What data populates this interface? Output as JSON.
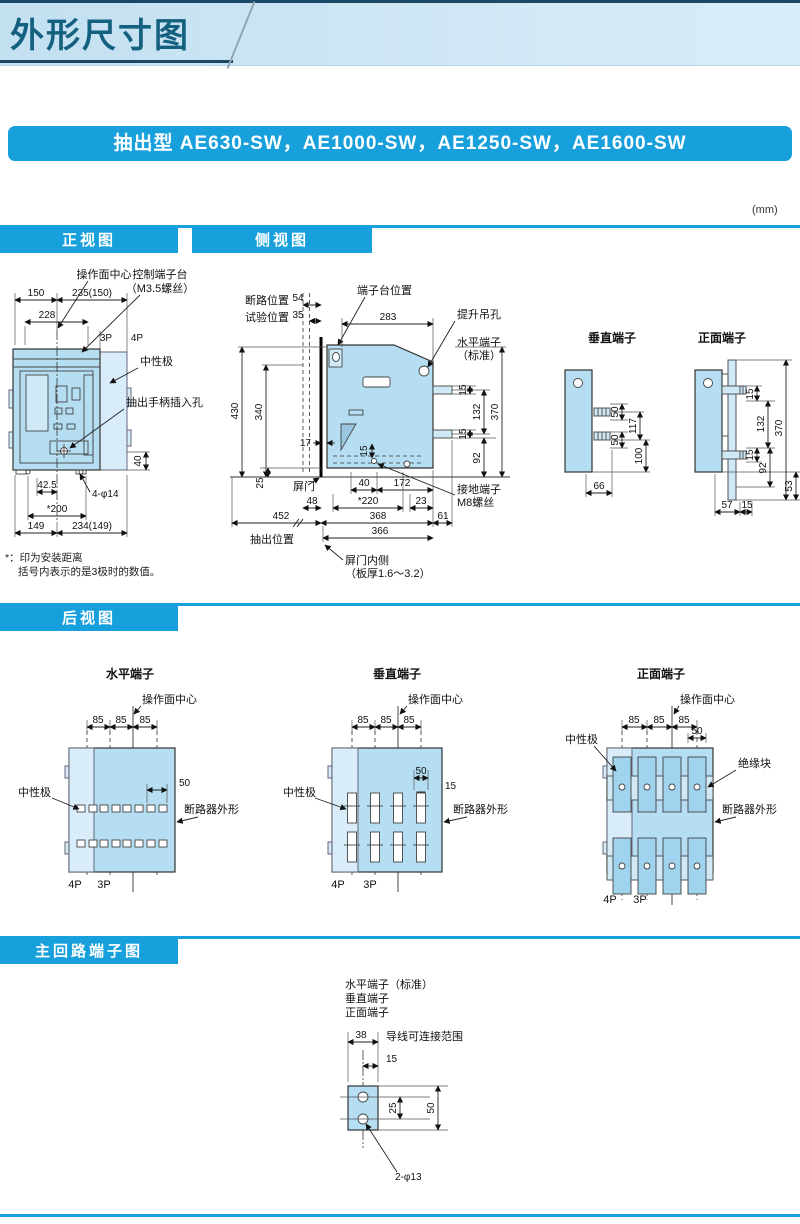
{
  "page": {
    "title": "外形尺寸图",
    "unit_note": "(mm)",
    "banner": "抽出型 AE630-SW，AE1000-SW，AE1250-SW，AE1600-SW",
    "colors": {
      "accent": "#18a0dc",
      "title_text": "#14607f",
      "body_fill": "#b5def2",
      "body_fill_light": "#d8edf9"
    }
  },
  "section_titles": {
    "front": "正视图",
    "side": "侧视图",
    "rear": "后视图",
    "main": "主回路端子图"
  },
  "front_view": {
    "labels": {
      "op_center": "操作面中心",
      "ctrl_block_1": "控制端子台",
      "ctrl_block_2": "（M3.5螺丝）",
      "p3": "3P",
      "p4": "4P",
      "neutral": "中性极",
      "handle_hole": "抽出手柄插入孔",
      "mount_holes": "4-φ14"
    },
    "dims": {
      "top_left": "150",
      "top_right": "235(150)",
      "width_228": "228",
      "bottom_42_5": "42.5",
      "bottom_200": "*200",
      "bottom_149": "149",
      "bottom_234": "234(149)",
      "side_40": "40"
    },
    "notes": [
      "*：印为安装距离",
      "括号内表示的是3极时的数值。"
    ]
  },
  "side_view": {
    "labels": {
      "open_pos": "断路位置",
      "open_val": "54",
      "test_pos": "试验位置",
      "test_val": "35",
      "terminal_pos": "端子台位置",
      "lift_hole": "提升吊孔",
      "horiz_term_1": "水平端子",
      "horiz_term_2": "（标准）",
      "door": "屏门",
      "ground_1": "接地端子",
      "ground_2": "M8螺丝",
      "drawout_pos": "抽出位置",
      "door_inner_1": "屏门内侧",
      "door_inner_2": "（板厚1.6～3.2）"
    },
    "dims": {
      "depth_283": "283",
      "h430": "430",
      "h340": "340",
      "d17": "17",
      "d15": "15",
      "d25": "25",
      "d40": "40",
      "d172": "172",
      "d48": "48",
      "d220": "*220",
      "d23": "23",
      "d452": "452",
      "d368": "368",
      "d61": "61",
      "d366": "366",
      "r15t": "15",
      "r132": "132",
      "r370": "370",
      "r15b": "15",
      "r92": "92"
    }
  },
  "vertical_terminal": {
    "title": "垂直端子",
    "dims": {
      "d50t": "50",
      "d117": "117",
      "d50b": "50",
      "d100": "100",
      "d66": "66"
    }
  },
  "front_terminal": {
    "title": "正面端子",
    "dims": {
      "d15t": "15",
      "d132": "132",
      "d370": "370",
      "d15b": "15",
      "d92": "92",
      "d53": "53",
      "d57": "57",
      "d15s": "15"
    }
  },
  "rear_view": {
    "horizontal": {
      "title": "水平端子",
      "op_center": "操作面中心",
      "pitch": [
        "85",
        "85",
        "85"
      ],
      "d50": "50",
      "neutral": "中性极",
      "outline": "断路器外形",
      "p4": "4P",
      "p3": "3P"
    },
    "vertical": {
      "title": "垂直端子",
      "op_center": "操作面中心",
      "pitch": [
        "85",
        "85",
        "85"
      ],
      "d50": "50",
      "d15": "15",
      "neutral": "中性极",
      "outline": "断路器外形",
      "p4": "4P",
      "p3": "3P"
    },
    "front": {
      "title": "正面端子",
      "op_center": "操作面中心",
      "pitch": [
        "85",
        "85",
        "85"
      ],
      "d50": "50",
      "insulator": "绝缘块",
      "neutral": "中性极",
      "outline": "断路器外形",
      "p4": "4P",
      "p3": "3P"
    }
  },
  "main_circuit": {
    "terminal_types": [
      "水平端子（标准）",
      "垂直端子",
      "正面端子"
    ],
    "dims": {
      "d38": "38",
      "d15": "15",
      "d25": "25",
      "d50": "50"
    },
    "range_label": "导线可连接范围",
    "holes_label": "2-φ13"
  }
}
